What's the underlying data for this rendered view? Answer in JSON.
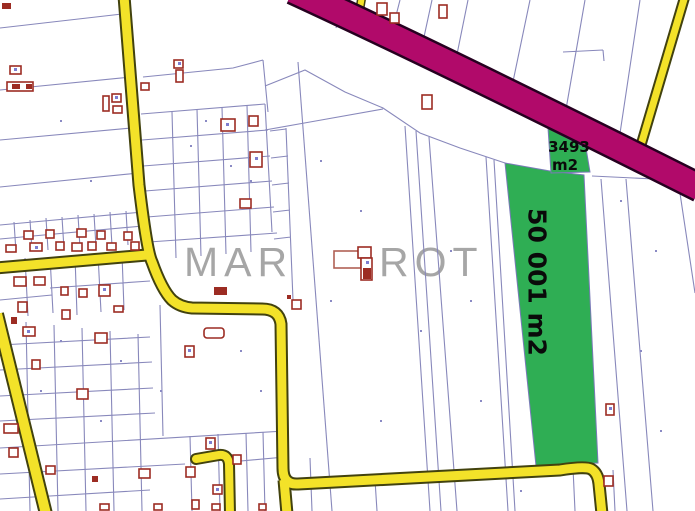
{
  "map": {
    "watermark": {
      "left": "MAR",
      "right": "ROT"
    },
    "highlighted_parcels": {
      "main": {
        "area_label": "50 001 m2"
      },
      "secondary": {
        "area_value": "3493",
        "area_unit": "m2"
      }
    },
    "colors": {
      "parcel_highlight": "#2fae54",
      "road_minor": "#f3e229",
      "road_major": "#b10a6a",
      "boundary": "#8888bb",
      "building_outline": "#9c2c23",
      "watermark": "#9f9f9f"
    }
  }
}
